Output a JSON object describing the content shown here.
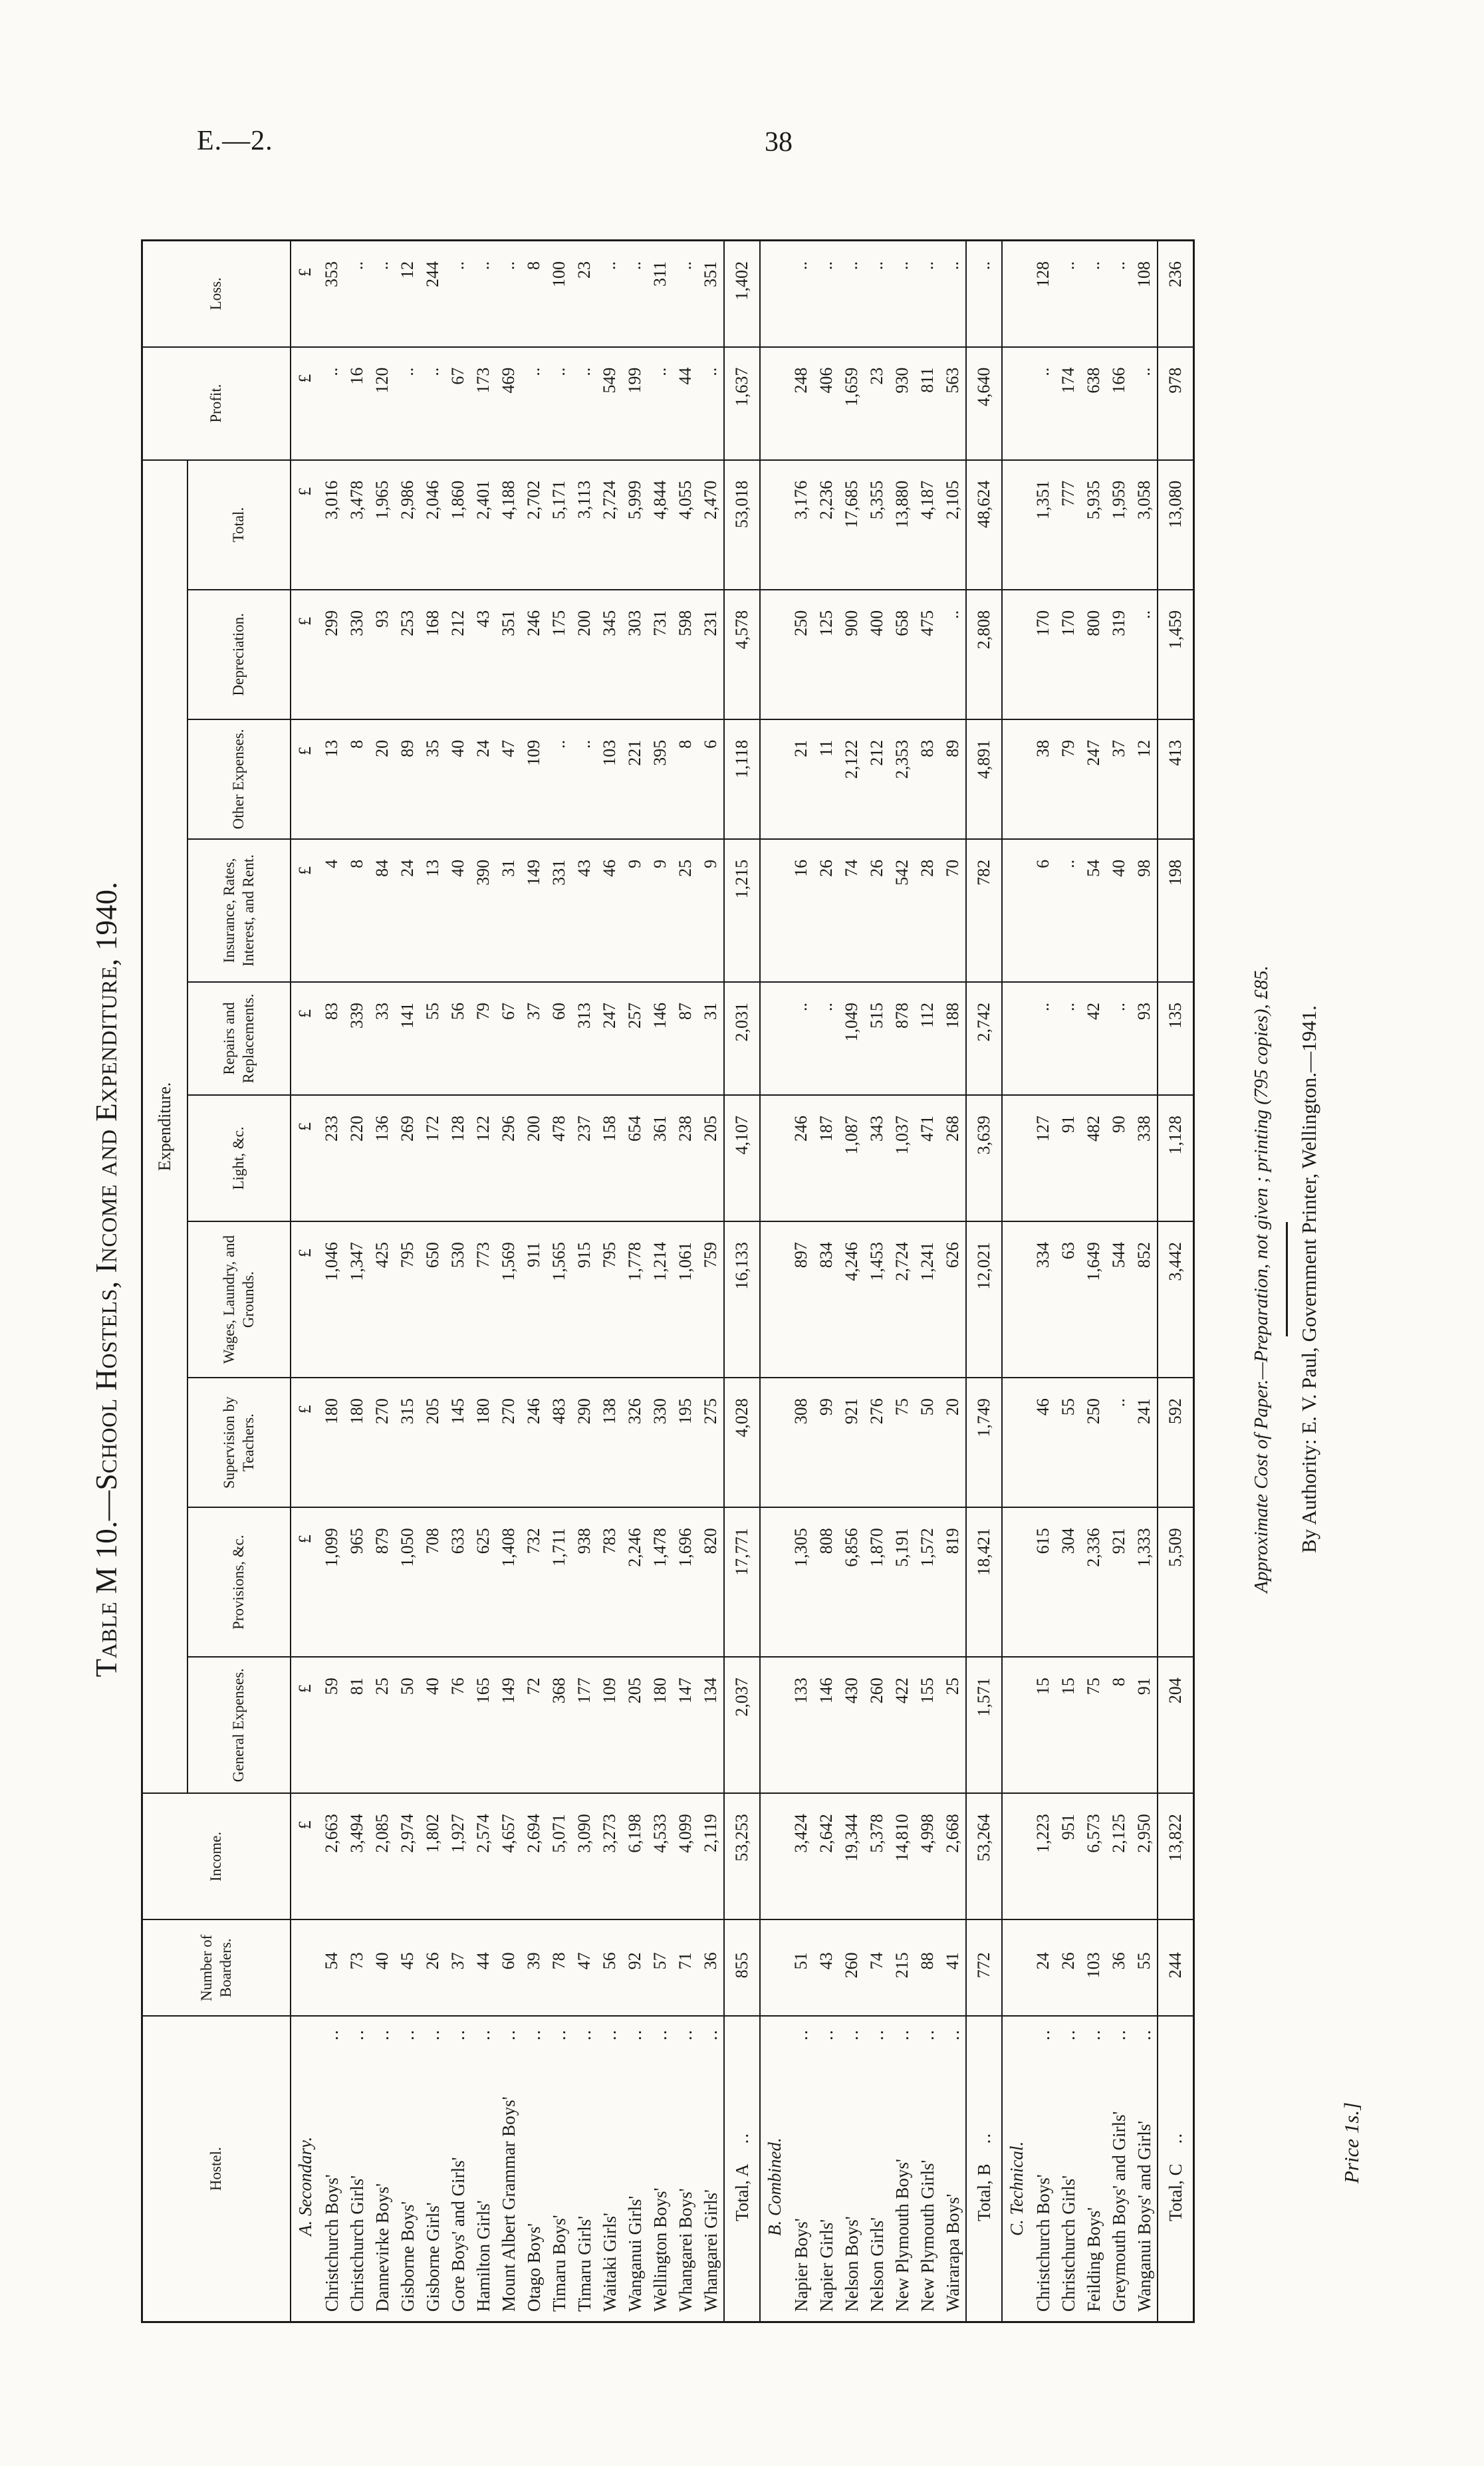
{
  "page": {
    "doc_ref": "E.—2.",
    "page_number": "38"
  },
  "title": "Table M 10.—School Hostels, Income and Expenditure, 1940.",
  "table": {
    "group_header": "Expenditure.",
    "currency_symbol": "£",
    "leader_dots": "..",
    "columns": [
      "Hostel.",
      "Number of Boarders.",
      "Income.",
      "General Expenses.",
      "Provisions, &c.",
      "Supervision by Teachers.",
      "Wages, Laundry, and Grounds.",
      "Light, &c.",
      "Repairs and Replacements.",
      "Insurance, Rates, Interest, and Rent.",
      "Other Expenses.",
      "Depreciation.",
      "Total.",
      "Profit.",
      "Loss."
    ],
    "sections": [
      {
        "heading": "A. Secondary.",
        "currency_row": true,
        "rows": [
          {
            "name": "Christchurch Boys'",
            "values": [
              "54",
              "2,663",
              "59",
              "1,099",
              "180",
              "1,046",
              "233",
              "83",
              "4",
              "13",
              "299",
              "3,016",
              "..",
              "353"
            ]
          },
          {
            "name": "Christchurch Girls'",
            "values": [
              "73",
              "3,494",
              "81",
              "965",
              "180",
              "1,347",
              "220",
              "339",
              "8",
              "8",
              "330",
              "3,478",
              "16",
              ".."
            ]
          },
          {
            "name": "Dannevirke Boys'",
            "values": [
              "40",
              "2,085",
              "25",
              "879",
              "270",
              "425",
              "136",
              "33",
              "84",
              "20",
              "93",
              "1,965",
              "120",
              ".."
            ]
          },
          {
            "name": "Gisborne Boys'",
            "values": [
              "45",
              "2,974",
              "50",
              "1,050",
              "315",
              "795",
              "269",
              "141",
              "24",
              "89",
              "253",
              "2,986",
              "..",
              "12"
            ]
          },
          {
            "name": "Gisborne Girls'",
            "values": [
              "26",
              "1,802",
              "40",
              "708",
              "205",
              "650",
              "172",
              "55",
              "13",
              "35",
              "168",
              "2,046",
              "..",
              "244"
            ]
          },
          {
            "name": "Gore Boys' and Girls'",
            "values": [
              "37",
              "1,927",
              "76",
              "633",
              "145",
              "530",
              "128",
              "56",
              "40",
              "40",
              "212",
              "1,860",
              "67",
              ".."
            ]
          },
          {
            "name": "Hamilton Girls'",
            "values": [
              "44",
              "2,574",
              "165",
              "625",
              "180",
              "773",
              "122",
              "79",
              "390",
              "24",
              "43",
              "2,401",
              "173",
              ".."
            ]
          },
          {
            "name": "Mount Albert Grammar Boys'",
            "values": [
              "60",
              "4,657",
              "149",
              "1,408",
              "270",
              "1,569",
              "296",
              "67",
              "31",
              "47",
              "351",
              "4,188",
              "469",
              ".."
            ]
          },
          {
            "name": "Otago Boys'",
            "values": [
              "39",
              "2,694",
              "72",
              "732",
              "246",
              "911",
              "200",
              "37",
              "149",
              "109",
              "246",
              "2,702",
              "..",
              "8"
            ]
          },
          {
            "name": "Timaru Boys'",
            "values": [
              "78",
              "5,071",
              "368",
              "1,711",
              "483",
              "1,565",
              "478",
              "60",
              "331",
              "..",
              "175",
              "5,171",
              "..",
              "100"
            ]
          },
          {
            "name": "Timaru Girls'",
            "values": [
              "47",
              "3,090",
              "177",
              "938",
              "290",
              "915",
              "237",
              "313",
              "43",
              "..",
              "200",
              "3,113",
              "..",
              "23"
            ]
          },
          {
            "name": "Waitaki Girls'",
            "values": [
              "56",
              "3,273",
              "109",
              "783",
              "138",
              "795",
              "158",
              "247",
              "46",
              "103",
              "345",
              "2,724",
              "549",
              ".."
            ]
          },
          {
            "name": "Wanganui Girls'",
            "values": [
              "92",
              "6,198",
              "205",
              "2,246",
              "326",
              "1,778",
              "654",
              "257",
              "9",
              "221",
              "303",
              "5,999",
              "199",
              ".."
            ]
          },
          {
            "name": "Wellington Boys'",
            "values": [
              "57",
              "4,533",
              "180",
              "1,478",
              "330",
              "1,214",
              "361",
              "146",
              "9",
              "395",
              "731",
              "4,844",
              "..",
              "311"
            ]
          },
          {
            "name": "Whangarei Boys'",
            "values": [
              "71",
              "4,099",
              "147",
              "1,696",
              "195",
              "1,061",
              "238",
              "87",
              "25",
              "8",
              "598",
              "4,055",
              "44",
              ".."
            ]
          },
          {
            "name": "Whangarei Girls'",
            "values": [
              "36",
              "2,119",
              "134",
              "820",
              "275",
              "759",
              "205",
              "31",
              "9",
              "6",
              "231",
              "2,470",
              "..",
              "351"
            ]
          }
        ],
        "total": {
          "label": "Total, A",
          "values": [
            "855",
            "53,253",
            "2,037",
            "17,771",
            "4,028",
            "16,133",
            "4,107",
            "2,031",
            "1,215",
            "1,118",
            "4,578",
            "53,018",
            "1,637",
            "1,402"
          ]
        }
      },
      {
        "heading": "B. Combined.",
        "currency_row": false,
        "rows": [
          {
            "name": "Napier Boys'",
            "values": [
              "51",
              "3,424",
              "133",
              "1,305",
              "308",
              "897",
              "246",
              "..",
              "16",
              "21",
              "250",
              "3,176",
              "248",
              ".."
            ]
          },
          {
            "name": "Napier Girls'",
            "values": [
              "43",
              "2,642",
              "146",
              "808",
              "99",
              "834",
              "187",
              "..",
              "26",
              "11",
              "125",
              "2,236",
              "406",
              ".."
            ]
          },
          {
            "name": "Nelson Boys'",
            "values": [
              "260",
              "19,344",
              "430",
              "6,856",
              "921",
              "4,246",
              "1,087",
              "1,049",
              "74",
              "2,122",
              "900",
              "17,685",
              "1,659",
              ".."
            ]
          },
          {
            "name": "Nelson Girls'",
            "values": [
              "74",
              "5,378",
              "260",
              "1,870",
              "276",
              "1,453",
              "343",
              "515",
              "26",
              "212",
              "400",
              "5,355",
              "23",
              ".."
            ]
          },
          {
            "name": "New Plymouth Boys'",
            "values": [
              "215",
              "14,810",
              "422",
              "5,191",
              "75",
              "2,724",
              "1,037",
              "878",
              "542",
              "2,353",
              "658",
              "13,880",
              "930",
              ".."
            ]
          },
          {
            "name": "New Plymouth Girls'",
            "values": [
              "88",
              "4,998",
              "155",
              "1,572",
              "50",
              "1,241",
              "471",
              "112",
              "28",
              "83",
              "475",
              "4,187",
              "811",
              ".."
            ]
          },
          {
            "name": "Wairarapa Boys'",
            "values": [
              "41",
              "2,668",
              "25",
              "819",
              "20",
              "626",
              "268",
              "188",
              "70",
              "89",
              "..",
              "2,105",
              "563",
              ".."
            ]
          }
        ],
        "total": {
          "label": "Total, B",
          "values": [
            "772",
            "53,264",
            "1,571",
            "18,421",
            "1,749",
            "12,021",
            "3,639",
            "2,742",
            "782",
            "4,891",
            "2,808",
            "48,624",
            "4,640",
            ".."
          ]
        }
      },
      {
        "heading": "C. Technical.",
        "currency_row": false,
        "rows": [
          {
            "name": "Christchurch Boys'",
            "values": [
              "24",
              "1,223",
              "15",
              "615",
              "46",
              "334",
              "127",
              "..",
              "6",
              "38",
              "170",
              "1,351",
              "..",
              "128"
            ]
          },
          {
            "name": "Christchurch Girls'",
            "values": [
              "26",
              "951",
              "15",
              "304",
              "55",
              "63",
              "91",
              "..",
              "..",
              "79",
              "170",
              "777",
              "174",
              ".."
            ]
          },
          {
            "name": "Feilding Boys'",
            "values": [
              "103",
              "6,573",
              "75",
              "2,336",
              "250",
              "1,649",
              "482",
              "42",
              "54",
              "247",
              "800",
              "5,935",
              "638",
              ".."
            ]
          },
          {
            "name": "Greymouth Boys' and Girls'",
            "values": [
              "36",
              "2,125",
              "8",
              "921",
              "..",
              "544",
              "90",
              "..",
              "40",
              "37",
              "319",
              "1,959",
              "166",
              ".."
            ]
          },
          {
            "name": "Wanganui Boys' and Girls'",
            "values": [
              "55",
              "2,950",
              "91",
              "1,333",
              "241",
              "852",
              "338",
              "93",
              "98",
              "12",
              "..",
              "3,058",
              "..",
              "108"
            ]
          }
        ],
        "total": {
          "label": "Total, C",
          "values": [
            "244",
            "13,822",
            "204",
            "5,509",
            "592",
            "3,442",
            "1,128",
            "135",
            "198",
            "413",
            "1,459",
            "13,080",
            "978",
            "236"
          ]
        }
      }
    ]
  },
  "footer": {
    "cost_note": "Approximate Cost of Paper.—Preparation, not given ; printing (795 copies), £85.",
    "authority": "By Authority: E. V. Paul, Government Printer, Wellington.—1941.",
    "price": "Price 1s.]"
  }
}
